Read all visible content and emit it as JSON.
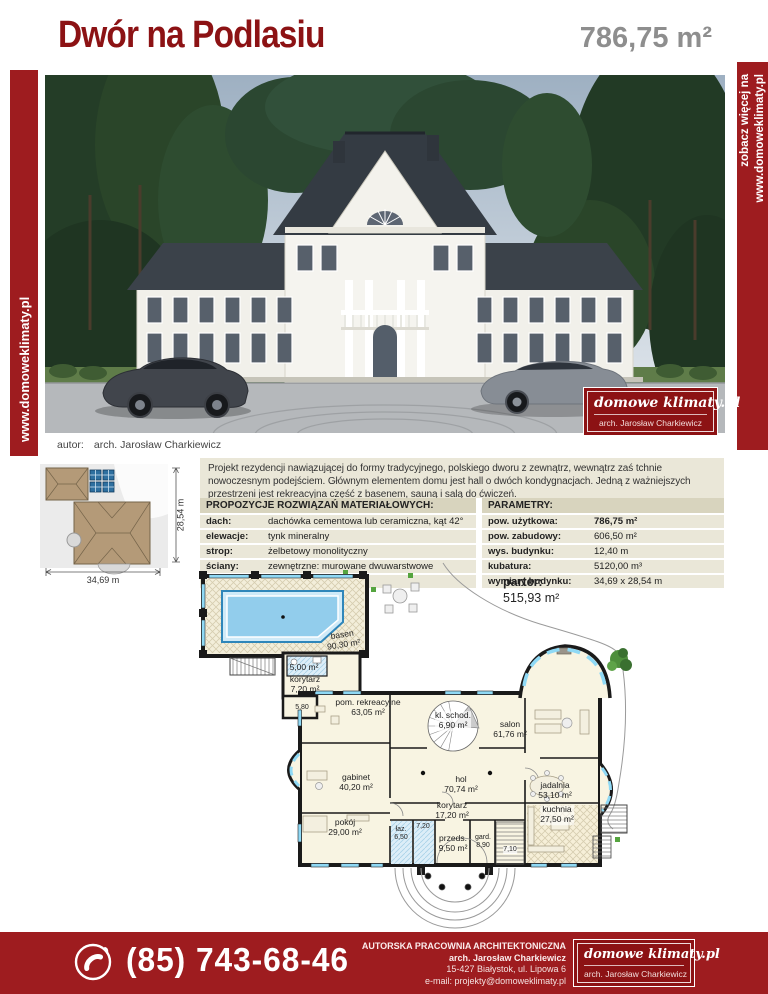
{
  "colors": {
    "red": "#9e1c1f",
    "red-dark": "#8c1214",
    "gray-num": "#8e8e8e",
    "beige": "#eae7d8",
    "beige-hd": "#d8d4be"
  },
  "header": {
    "title": "Dwór na Podlasiu",
    "total_area": "786,75 m²"
  },
  "strips": {
    "left_url": "www.domoweklimaty.pl",
    "right_line1": "zobacz więcej na",
    "right_line2": "www.domoweklimaty.pl"
  },
  "photo": {
    "caption_label": "autor:",
    "caption_value": "arch. Jarosław Charkiewicz",
    "logo": {
      "brand": "domowe klimaty.pl",
      "author": "arch. Jarosław Charkiewicz"
    }
  },
  "siteplan": {
    "width_dim": "34,69 m",
    "height_dim": "28,54 m"
  },
  "description": "Projekt rezydencji nawiązującej do formy tradycyjnego, polskiego dworu z zewnątrz, wewnątrz zaś tchnie nowoczesnym podejściem. Głównym elementem domu jest hall o dwóch kondygnacjach. Jedną z ważniejszych przestrzeni jest rekreacyjna część z basenem, sauną i salą do ćwiczeń.",
  "materials": {
    "header": "PROPOZYCJE ROZWIĄZAŃ MATERIAŁOWYCH:",
    "rows": [
      {
        "label": "dach:",
        "value": "dachówka cementowa lub ceramiczna, kąt 42°"
      },
      {
        "label": "elewacje:",
        "value": "tynk mineralny"
      },
      {
        "label": "strop:",
        "value": "żelbetowy monolityczny"
      },
      {
        "label": "ściany:",
        "value": "zewnętrzne: murowane dwuwarstwowe"
      },
      {
        "label": "",
        "value": "wewnętrzne: murowane"
      }
    ]
  },
  "parameters": {
    "header": "PARAMETRY:",
    "rows": [
      {
        "label": "pow. użytkowa:",
        "value": "786,75 m²"
      },
      {
        "label": "pow. zabudowy:",
        "value": "606,50 m²"
      },
      {
        "label": "wys. budynku:",
        "value": "12,40 m"
      },
      {
        "label": "kubatura:",
        "value": "5120,00 m³"
      },
      {
        "label": "wymiary budynku:",
        "value": "34,69 x 28,54 m"
      }
    ]
  },
  "floorplan": {
    "title_line1": "parter:",
    "title_line2": "515,93 m²",
    "labels": [
      {
        "name": "basen",
        "area": "90,30 m²"
      },
      {
        "name": "",
        "area": "5,00 m²"
      },
      {
        "name": "korytarz",
        "area": "7,20 m²"
      },
      {
        "name": "",
        "area": "5,80"
      },
      {
        "name": "pom. rekreacyjne",
        "area": "63,05 m²"
      },
      {
        "name": "kl. schod.",
        "area": "6,90 m²"
      },
      {
        "name": "salon",
        "area": "61,76 m²"
      },
      {
        "name": "gabinet",
        "area": "40,20 m²"
      },
      {
        "name": "hol",
        "area": "70,74 m²"
      },
      {
        "name": "jadalnia",
        "area": "53,10 m²"
      },
      {
        "name": "korytarz",
        "area": "17,20 m²"
      },
      {
        "name": "pokój",
        "area": "29,00 m²"
      },
      {
        "name": "łaz.",
        "area": "6,50"
      },
      {
        "name": "",
        "area": "7,20"
      },
      {
        "name": "przeds.",
        "area": "9,50 m²"
      },
      {
        "name": "gard.",
        "area": "8,90"
      },
      {
        "name": "",
        "area": "7,10"
      },
      {
        "name": "kuchnia",
        "area": "27,50 m²"
      }
    ]
  },
  "footer": {
    "phone": "(85) 743-68-46",
    "line1": "AUTORSKA PRACOWNIA ARCHITEKTONICZNA",
    "line2": "arch. Jarosław Charkiewicz",
    "line3": "15-427 Białystok, ul. Lipowa 6",
    "line4": "e-mail: projekty@domoweklimaty.pl",
    "logo": {
      "brand": "domowe klimaty.pl",
      "author": "arch. Jarosław Charkiewicz"
    }
  }
}
